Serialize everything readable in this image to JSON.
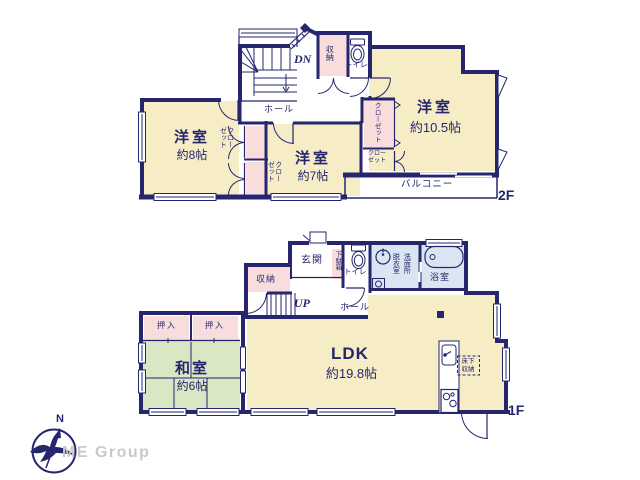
{
  "floor2": {
    "label": "2F",
    "stairs": "DN",
    "hall": "ホール",
    "storage": "収納",
    "toilet": "トイレ",
    "room8_name": "洋室",
    "room8_size": "約8帖",
    "room7_name": "洋室",
    "room7_size": "約7帖",
    "room105_name": "洋室",
    "room105_size": "約10.5帖",
    "closet_8a": "クローゼット",
    "closet_8b": "クローゼット",
    "closet_10a": "クローゼット",
    "closet_10b": "クローゼット",
    "balcony": "バルコニー"
  },
  "floor1": {
    "label": "1F",
    "stairs": "UP",
    "entrance": "玄関",
    "shoe_cabinet": "下駄箱",
    "toilet": "トイレ",
    "changing_room": "脱衣室",
    "washroom": "洗面所",
    "bathroom": "浴室",
    "hall": "ホール",
    "storage": "収納",
    "ldk_name": "LDK",
    "ldk_size": "約19.8帖",
    "washitsu_name": "和室",
    "washitsu_size": "約6帖",
    "oshiire_a": "押入",
    "oshiire_b": "押入",
    "underfloor": "床下収納"
  },
  "compass": {
    "north": "N"
  },
  "branding": {
    "logo": "ME Group"
  },
  "colors": {
    "wall": "#26266e",
    "room_cream": "#f6ecc5",
    "closet_pink": "#f9dddd",
    "tatami_green": "#d9e7c5",
    "wet_blue": "#d9e6f2",
    "logo_gray": "#c9c9c9"
  }
}
